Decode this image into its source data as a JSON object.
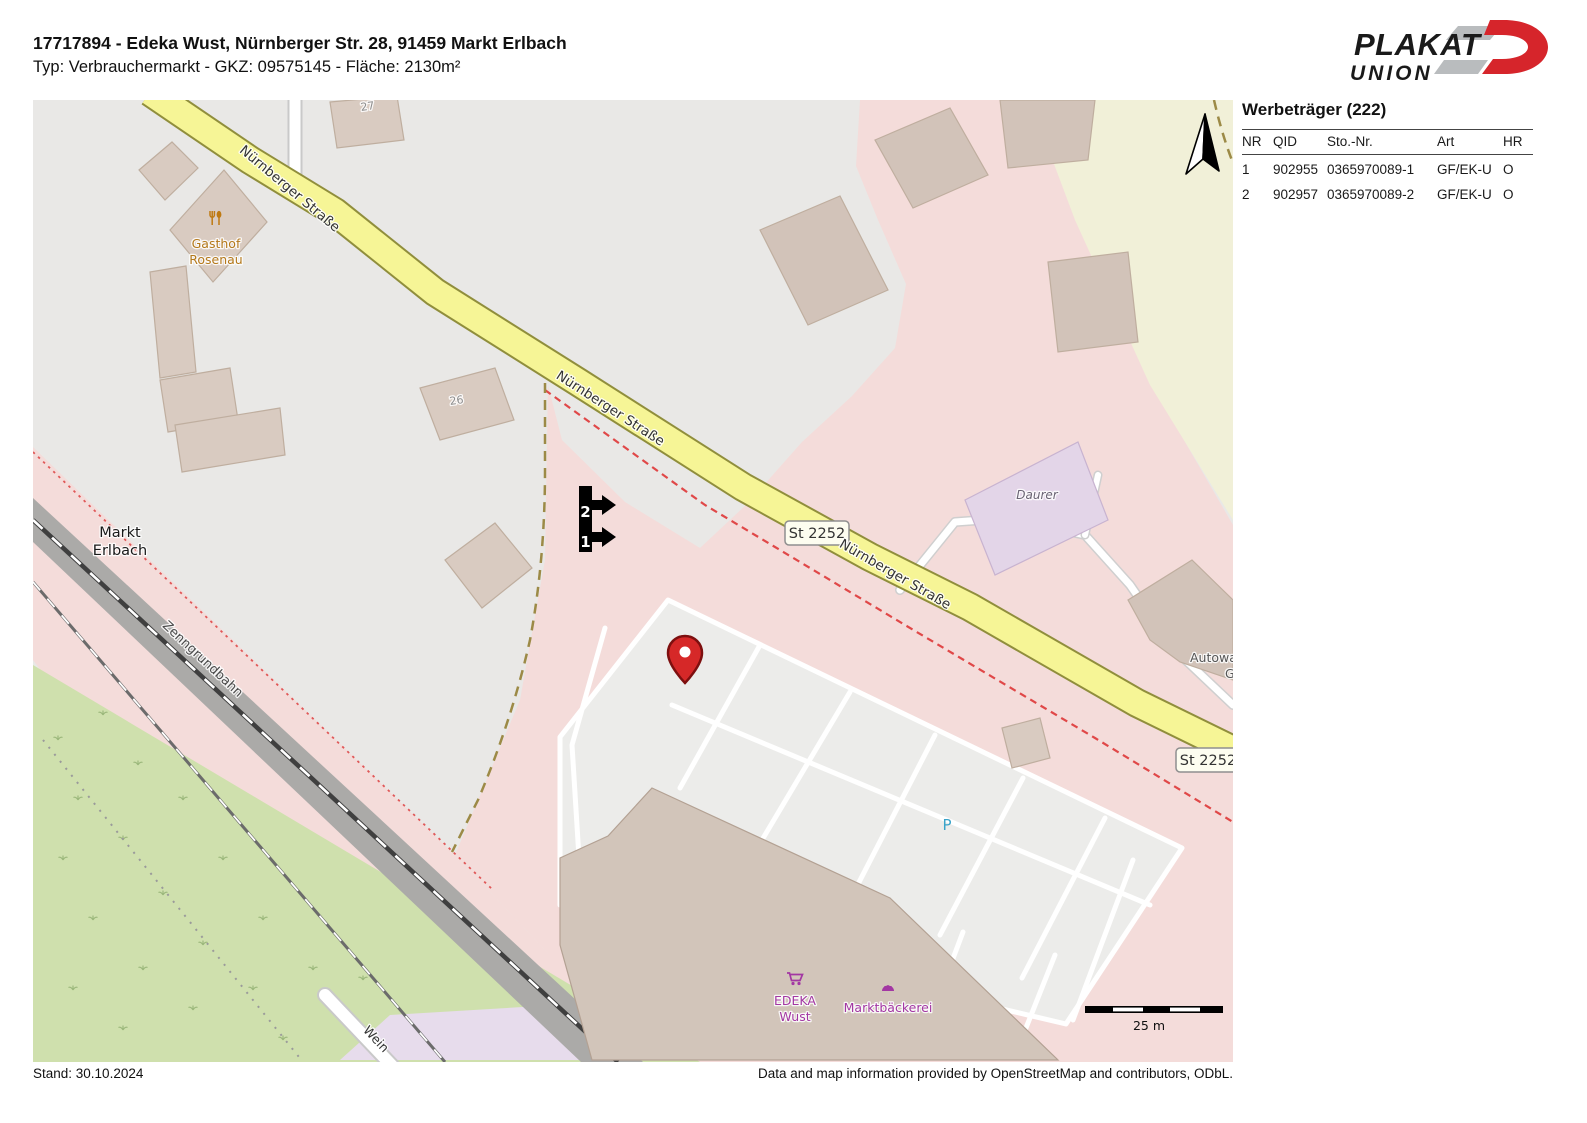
{
  "header": {
    "line1": "17717894 - Edeka Wust, Nürnberger Str. 28, 91459 Markt Erlbach",
    "line2": "Typ: Verbrauchermarkt - GKZ: 09575145 - Fläche: 2130m²"
  },
  "logo": {
    "line1": "PLAKAT",
    "line2": "UNION"
  },
  "colors": {
    "brand_red": "#d6252b",
    "pin_red": "#d62828",
    "road_yellow": "#f6f596",
    "retail_pink": "#f4dcda"
  },
  "panel": {
    "title": "Werbeträger (222)",
    "columns": [
      "NR",
      "QID",
      "Sto.-Nr.",
      "Art",
      "HR"
    ],
    "rows": [
      [
        "1",
        "902955",
        "0365970089-1",
        "GF/EK-U",
        "O"
      ],
      [
        "2",
        "902957",
        "0365970089-2",
        "GF/EK-U",
        "O"
      ]
    ]
  },
  "map": {
    "street_name": "Nürnberger Straße",
    "road_ref": "St 2252",
    "gasthof1": "Gasthof",
    "gasthof2": "Rosenau",
    "place1": "Markt",
    "place2": "Erlbach",
    "railway": "Zenngrundbahn",
    "daurer": "Daurer",
    "house27": "27",
    "house26": "26",
    "parking_p": "P",
    "edeka1": "EDEKA",
    "edeka2": "Wust",
    "baeckerei": "Marktbäckerei",
    "autowas1": "Autowas",
    "autowas2": "G",
    "wein": "Wein",
    "marker1": "1",
    "marker2": "2",
    "scale_label": "25 m"
  },
  "footer": {
    "stand": "Stand: 30.10.2024",
    "attribution": "Data and map information provided by OpenStreetMap and contributors, ODbL."
  }
}
